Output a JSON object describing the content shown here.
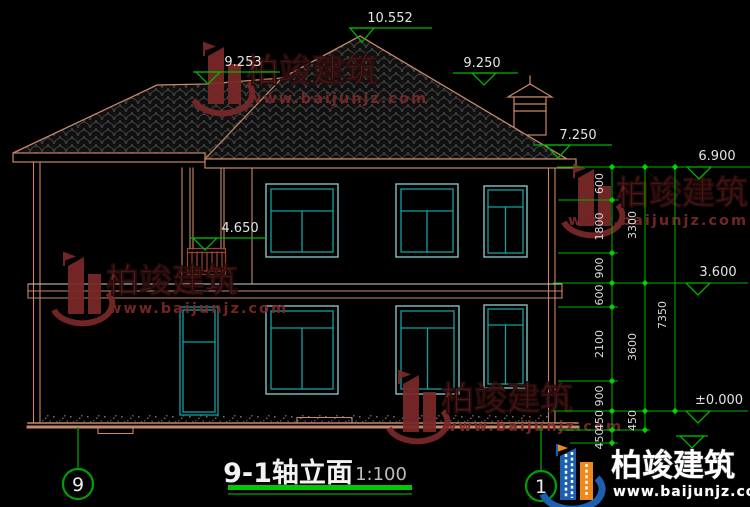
{
  "titleblock": {
    "title": "9-1轴立面",
    "scale": "1:100"
  },
  "axes": {
    "left_bubble": "9",
    "right_bubble": "1"
  },
  "markers": {
    "apex": "10.552",
    "porch_ridge": "9.253",
    "main_ridge_right": "9.250",
    "right_eave": "7.250",
    "parapet": "6.900",
    "balcony_rail": "4.650",
    "second_floor": "3.600",
    "ground": "±0.000"
  },
  "dims": {
    "chain_inner": [
      "600",
      "1800",
      "900",
      "600",
      "2100",
      "900",
      "450",
      "450"
    ],
    "chain_middle": [
      "3300",
      "3600",
      "450"
    ],
    "chain_outer": [
      "7350"
    ]
  },
  "watermark": {
    "name": "柏竣建筑",
    "url": "www.baijunjz.com"
  },
  "brand": {
    "name": "柏竣建筑",
    "url": "www.baijunjz.com"
  },
  "colors": {
    "background": "#000000",
    "outline": "#c98767",
    "dimension": "#00b400",
    "window": "#12a0a0",
    "railing": "#9a4434",
    "watermark": "#7b2828",
    "brand_blue": "#1d5fb0",
    "brand_orange": "#f0881c"
  }
}
